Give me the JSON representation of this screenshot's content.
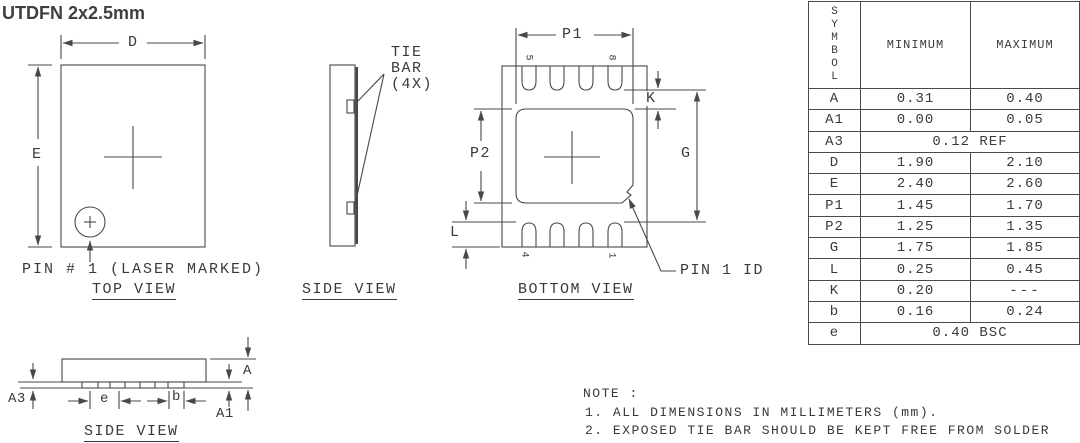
{
  "title": "UTDFN 2x2.5mm",
  "views": {
    "top": {
      "label": "TOP VIEW",
      "pin1_note": "PIN # 1 (LASER MARKED)",
      "dims": {
        "d": "D",
        "e": "E"
      }
    },
    "side": {
      "label": "SIDE VIEW",
      "tie_bar_line1": "TIE",
      "tie_bar_line2": "BAR",
      "tie_bar_line3": "(4X)"
    },
    "bottom": {
      "label": "BOTTOM VIEW",
      "pin1_id": "PIN 1 ID",
      "pins": {
        "p5": "5",
        "p8": "8",
        "p4": "4",
        "p1": "1"
      },
      "dims": {
        "p1": "P1",
        "p2": "P2",
        "k": "K",
        "g": "G",
        "l": "L"
      }
    },
    "side2": {
      "label": "SIDE VIEW",
      "dims": {
        "a3": "A3",
        "e": "e",
        "b": "b",
        "a": "A",
        "a1": "A1"
      }
    }
  },
  "table": {
    "headers": {
      "symbol": "SYMBOL",
      "min": "MINIMUM",
      "max": "MAXIMUM"
    },
    "rows": [
      {
        "symbol": "A",
        "min": "0.31",
        "max": "0.40"
      },
      {
        "symbol": "A1",
        "min": "0.00",
        "max": "0.05"
      },
      {
        "symbol": "A3",
        "span": "0.12 REF"
      },
      {
        "symbol": "D",
        "min": "1.90",
        "max": "2.10"
      },
      {
        "symbol": "E",
        "min": "2.40",
        "max": "2.60"
      },
      {
        "symbol": "P1",
        "min": "1.45",
        "max": "1.70"
      },
      {
        "symbol": "P2",
        "min": "1.25",
        "max": "1.35"
      },
      {
        "symbol": "G",
        "min": "1.75",
        "max": "1.85"
      },
      {
        "symbol": "L",
        "min": "0.25",
        "max": "0.45"
      },
      {
        "symbol": "K",
        "min": "0.20",
        "max": "---"
      },
      {
        "symbol": "b",
        "min": "0.16",
        "max": "0.24"
      },
      {
        "symbol": "e",
        "span": "0.40 BSC"
      }
    ]
  },
  "notes": {
    "heading": "NOTE :",
    "items": [
      "1. ALL DIMENSIONS IN MILLIMETERS (mm).",
      "2. EXPOSED TIE BAR SHOULD BE KEPT FREE FROM SOLDER"
    ]
  },
  "colors": {
    "line": "#484848",
    "text": "#3a3a3a"
  }
}
